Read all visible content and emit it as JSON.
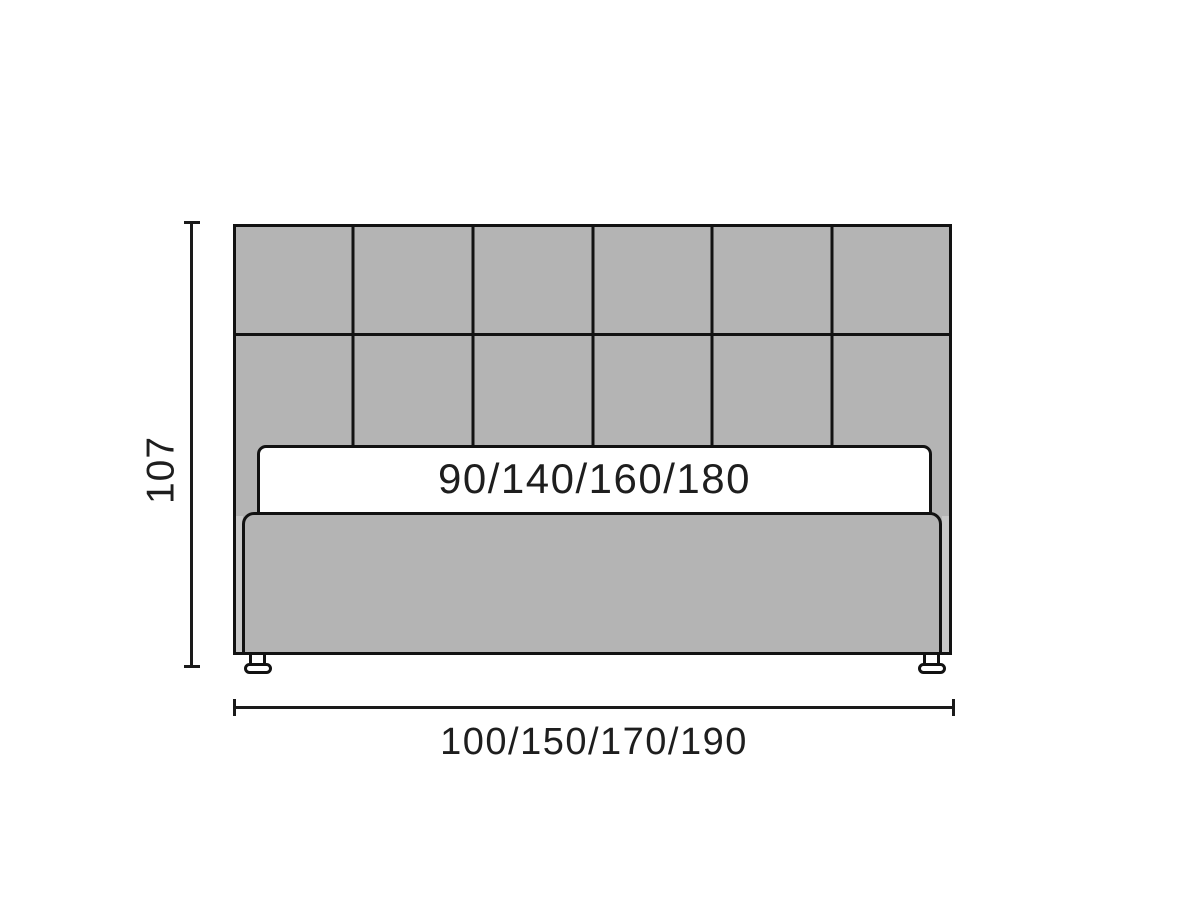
{
  "diagram": {
    "subject": "bed-front-view-dimension-drawing",
    "height_dimension": {
      "label": "107"
    },
    "mattress_dimension": {
      "label": "90/140/160/180"
    },
    "width_dimension": {
      "label": "100/150/170/190"
    },
    "headboard": {
      "columns": 6,
      "rows": 2,
      "row_spacing_px": 110.5
    },
    "feet_count": 2
  },
  "colors": {
    "upholstery_gray": "#b4b4b4",
    "upholstery_gray_light": "#c8c8c8",
    "outline": "#121212",
    "dimension_line": "#1a1a1a",
    "label_text": "#1e1e1e",
    "background": "#ffffff",
    "mattress_white": "#ffffff"
  }
}
